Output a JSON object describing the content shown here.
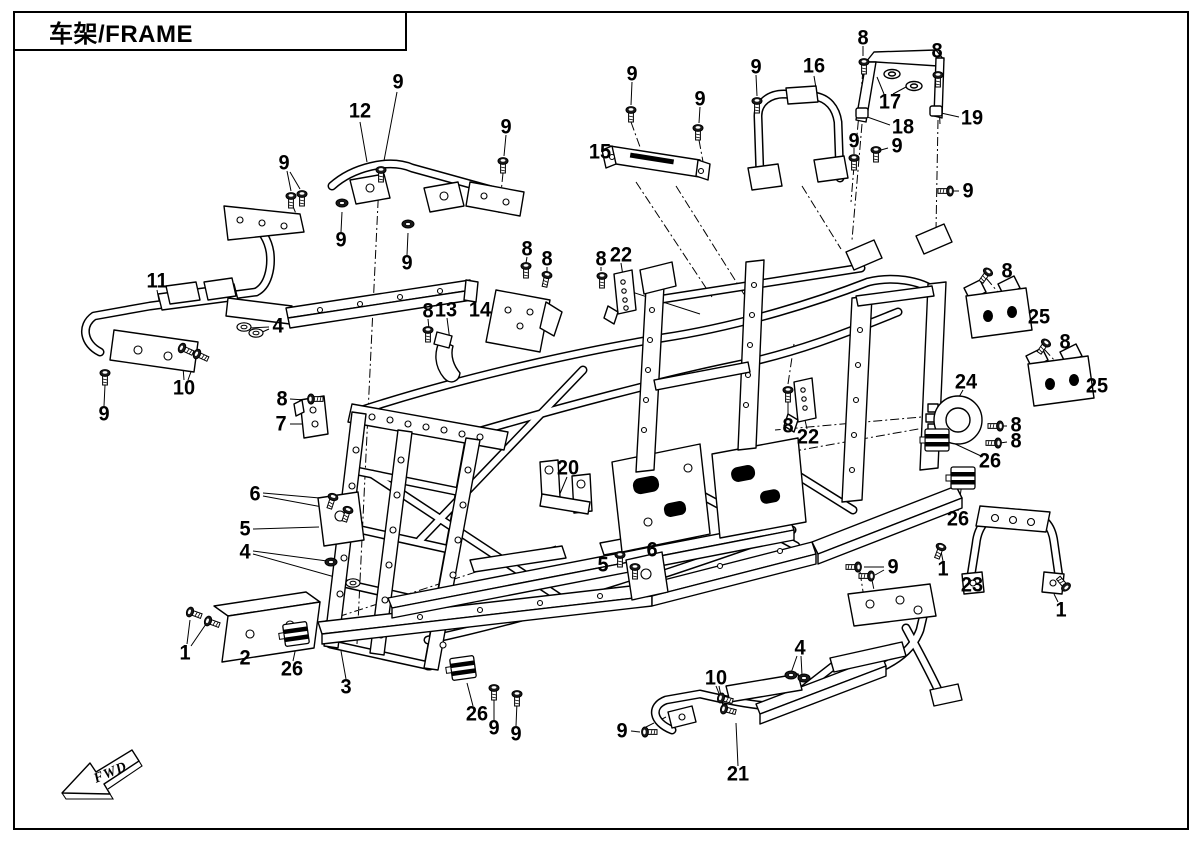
{
  "title": "车架/FRAME",
  "fwd_label": "FWD",
  "callouts": [
    {
      "n": "9",
      "x": 398,
      "y": 82
    },
    {
      "n": "12",
      "x": 360,
      "y": 111
    },
    {
      "n": "9",
      "x": 506,
      "y": 127
    },
    {
      "n": "9",
      "x": 284,
      "y": 163
    },
    {
      "n": "9",
      "x": 341,
      "y": 240
    },
    {
      "n": "9",
      "x": 407,
      "y": 263
    },
    {
      "n": "15",
      "x": 600,
      "y": 152
    },
    {
      "n": "9",
      "x": 632,
      "y": 74
    },
    {
      "n": "9",
      "x": 700,
      "y": 99
    },
    {
      "n": "9",
      "x": 756,
      "y": 67
    },
    {
      "n": "16",
      "x": 814,
      "y": 66
    },
    {
      "n": "8",
      "x": 863,
      "y": 38
    },
    {
      "n": "17",
      "x": 890,
      "y": 102
    },
    {
      "n": "8",
      "x": 937,
      "y": 51
    },
    {
      "n": "18",
      "x": 903,
      "y": 127
    },
    {
      "n": "19",
      "x": 972,
      "y": 118
    },
    {
      "n": "9",
      "x": 854,
      "y": 141
    },
    {
      "n": "9",
      "x": 897,
      "y": 146
    },
    {
      "n": "9",
      "x": 968,
      "y": 191
    },
    {
      "n": "11",
      "x": 157,
      "y": 281
    },
    {
      "n": "4",
      "x": 278,
      "y": 326
    },
    {
      "n": "10",
      "x": 184,
      "y": 388
    },
    {
      "n": "9",
      "x": 104,
      "y": 414
    },
    {
      "n": "8",
      "x": 282,
      "y": 399
    },
    {
      "n": "7",
      "x": 281,
      "y": 424
    },
    {
      "n": "8",
      "x": 428,
      "y": 311
    },
    {
      "n": "13",
      "x": 446,
      "y": 310
    },
    {
      "n": "14",
      "x": 480,
      "y": 310
    },
    {
      "n": "8",
      "x": 527,
      "y": 249
    },
    {
      "n": "8",
      "x": 547,
      "y": 259
    },
    {
      "n": "8",
      "x": 601,
      "y": 259
    },
    {
      "n": "22",
      "x": 621,
      "y": 255
    },
    {
      "n": "8",
      "x": 788,
      "y": 426
    },
    {
      "n": "22",
      "x": 808,
      "y": 437
    },
    {
      "n": "8",
      "x": 1007,
      "y": 271
    },
    {
      "n": "25",
      "x": 1039,
      "y": 317
    },
    {
      "n": "8",
      "x": 1065,
      "y": 342
    },
    {
      "n": "25",
      "x": 1097,
      "y": 386
    },
    {
      "n": "24",
      "x": 966,
      "y": 382
    },
    {
      "n": "8",
      "x": 1016,
      "y": 425
    },
    {
      "n": "8",
      "x": 1016,
      "y": 441
    },
    {
      "n": "26",
      "x": 990,
      "y": 461
    },
    {
      "n": "26",
      "x": 958,
      "y": 519
    },
    {
      "n": "20",
      "x": 568,
      "y": 468
    },
    {
      "n": "6",
      "x": 255,
      "y": 494
    },
    {
      "n": "5",
      "x": 245,
      "y": 529
    },
    {
      "n": "4",
      "x": 245,
      "y": 552
    },
    {
      "n": "5",
      "x": 603,
      "y": 565
    },
    {
      "n": "6",
      "x": 652,
      "y": 550
    },
    {
      "n": "1",
      "x": 185,
      "y": 653
    },
    {
      "n": "2",
      "x": 245,
      "y": 658
    },
    {
      "n": "26",
      "x": 292,
      "y": 669
    },
    {
      "n": "3",
      "x": 346,
      "y": 687
    },
    {
      "n": "26",
      "x": 477,
      "y": 714
    },
    {
      "n": "9",
      "x": 494,
      "y": 728
    },
    {
      "n": "9",
      "x": 516,
      "y": 734
    },
    {
      "n": "9",
      "x": 622,
      "y": 731
    },
    {
      "n": "10",
      "x": 716,
      "y": 678
    },
    {
      "n": "4",
      "x": 800,
      "y": 648
    },
    {
      "n": "21",
      "x": 738,
      "y": 774
    },
    {
      "n": "9",
      "x": 893,
      "y": 567
    },
    {
      "n": "1",
      "x": 943,
      "y": 569
    },
    {
      "n": "23",
      "x": 972,
      "y": 585
    },
    {
      "n": "1",
      "x": 1061,
      "y": 610
    }
  ]
}
